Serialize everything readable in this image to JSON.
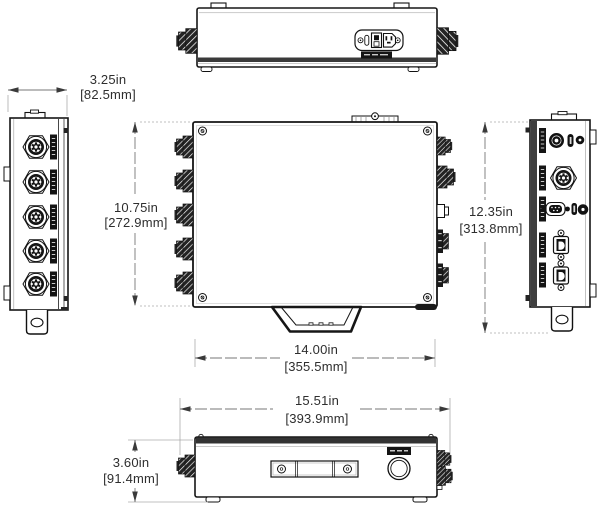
{
  "drawing": {
    "kind": "orthographic-dimension-drawing",
    "units": "inches [millimeters]",
    "dimensions": {
      "side_width": {
        "in": "3.25in",
        "mm": "[82.5mm]"
      },
      "front_height": {
        "in": "10.75in",
        "mm": "[272.9mm]"
      },
      "overall_height": {
        "in": "12.35in",
        "mm": "[313.8mm]"
      },
      "front_width": {
        "in": "14.00in",
        "mm": "[355.5mm]"
      },
      "overall_width": {
        "in": "15.51in",
        "mm": "[393.9mm]"
      },
      "side_height": {
        "in": "3.60in",
        "mm": "[91.4mm]"
      }
    },
    "colors": {
      "background": "#ffffff",
      "linework": "#1a1a1a",
      "dimension_line": "#777777",
      "extension_line": "#ababab",
      "dimension_text": "#2e2e2e"
    }
  }
}
